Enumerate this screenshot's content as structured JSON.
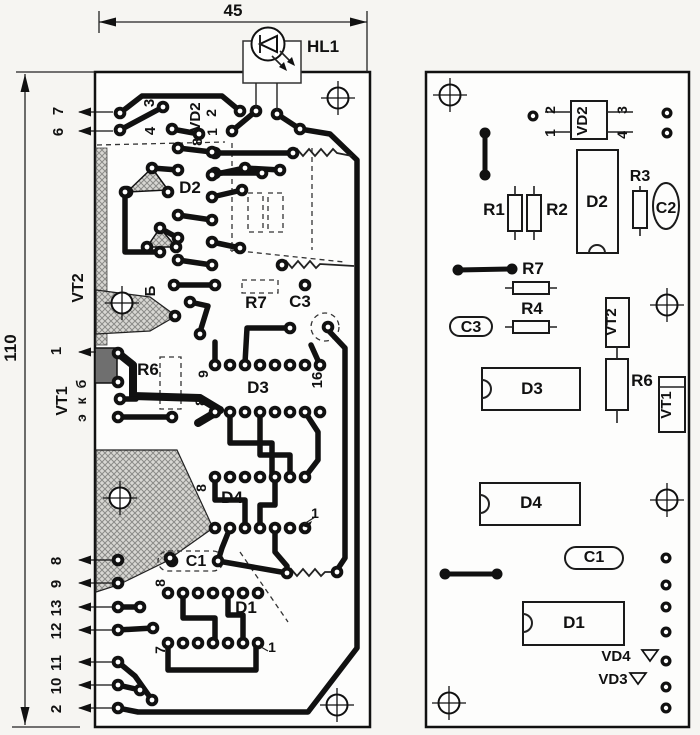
{
  "drawing": "printed-circuit-board-layout",
  "colors": {
    "ink": "#111111",
    "paper": "#f6f5f2",
    "board": "#fdfdfc",
    "copper_hatch": "#d8d7d3"
  },
  "board_dimensions": {
    "width_label": "45",
    "height_label": "110"
  },
  "labels": [
    {
      "t": "45",
      "x": 233,
      "y": 16,
      "r": 0,
      "s": 17,
      "g": "labels-anno"
    },
    {
      "t": "110",
      "x": 16,
      "y": 348,
      "r": -90,
      "s": 17,
      "g": "labels-anno"
    },
    {
      "t": "HL1",
      "x": 323,
      "y": 52,
      "r": 0,
      "s": 17,
      "g": "labels-anno"
    },
    {
      "t": "7",
      "x": 63,
      "y": 111,
      "r": -90,
      "s": 15,
      "g": "labels-left"
    },
    {
      "t": "6",
      "x": 63,
      "y": 132,
      "r": -90,
      "s": 15,
      "g": "labels-left"
    },
    {
      "t": "3",
      "x": 154,
      "y": 103,
      "r": -90,
      "s": 15,
      "g": "labels-left"
    },
    {
      "t": "4",
      "x": 155,
      "y": 131,
      "r": -90,
      "s": 15,
      "g": "labels-left"
    },
    {
      "t": "VD2",
      "x": 200,
      "y": 117,
      "r": -90,
      "s": 15,
      "g": "labels-left"
    },
    {
      "t": "2",
      "x": 216,
      "y": 113,
      "r": -90,
      "s": 14,
      "g": "labels-left"
    },
    {
      "t": "1",
      "x": 217,
      "y": 132,
      "r": -90,
      "s": 14,
      "g": "labels-left"
    },
    {
      "t": "8",
      "x": 202,
      "y": 142,
      "r": -90,
      "s": 14,
      "g": "labels-left"
    },
    {
      "t": "D2",
      "x": 190,
      "y": 193,
      "r": 0,
      "s": 17,
      "g": "labels-left"
    },
    {
      "t": "VT2",
      "x": 83,
      "y": 288,
      "r": -90,
      "s": 16,
      "g": "labels-left"
    },
    {
      "t": "Б",
      "x": 155,
      "y": 291,
      "r": -90,
      "s": 15,
      "g": "labels-left"
    },
    {
      "t": "R7",
      "x": 256,
      "y": 308,
      "r": 0,
      "s": 17,
      "g": "labels-left"
    },
    {
      "t": "C3",
      "x": 300,
      "y": 307,
      "r": 0,
      "s": 17,
      "g": "labels-left"
    },
    {
      "t": "1",
      "x": 61,
      "y": 351,
      "r": -90,
      "s": 15,
      "g": "labels-left"
    },
    {
      "t": "R6",
      "x": 148,
      "y": 375,
      "r": 0,
      "s": 17,
      "g": "labels-left"
    },
    {
      "t": "VT1",
      "x": 67,
      "y": 401,
      "r": -90,
      "s": 16,
      "g": "labels-left"
    },
    {
      "t": "б",
      "x": 86,
      "y": 384,
      "r": -90,
      "s": 14,
      "g": "labels-left"
    },
    {
      "t": "к",
      "x": 86,
      "y": 401,
      "r": -90,
      "s": 14,
      "g": "labels-left"
    },
    {
      "t": "э",
      "x": 86,
      "y": 418,
      "r": -90,
      "s": 14,
      "g": "labels-left"
    },
    {
      "t": "9",
      "x": 208,
      "y": 374,
      "r": -90,
      "s": 14,
      "g": "labels-left"
    },
    {
      "t": "16",
      "x": 322,
      "y": 380,
      "r": -90,
      "s": 15,
      "g": "labels-left"
    },
    {
      "t": "D3",
      "x": 258,
      "y": 393,
      "r": 0,
      "s": 17,
      "g": "labels-left"
    },
    {
      "t": "8",
      "x": 205,
      "y": 402,
      "r": -90,
      "s": 14,
      "g": "labels-left"
    },
    {
      "t": "8",
      "x": 206,
      "y": 488,
      "r": -90,
      "s": 14,
      "g": "labels-left"
    },
    {
      "t": "D4",
      "x": 232,
      "y": 503,
      "r": 0,
      "s": 17,
      "g": "labels-left"
    },
    {
      "t": "1",
      "x": 315,
      "y": 518,
      "r": 0,
      "s": 14,
      "g": "labels-left"
    },
    {
      "t": "C1",
      "x": 196,
      "y": 566,
      "r": 0,
      "s": 16,
      "g": "labels-left"
    },
    {
      "t": "8",
      "x": 165,
      "y": 583,
      "r": -90,
      "s": 14,
      "g": "labels-left"
    },
    {
      "t": "D1",
      "x": 246,
      "y": 613,
      "r": 0,
      "s": 17,
      "g": "labels-left"
    },
    {
      "t": "7",
      "x": 165,
      "y": 650,
      "r": -90,
      "s": 14,
      "g": "labels-left"
    },
    {
      "t": "1",
      "x": 272,
      "y": 652,
      "r": 0,
      "s": 14,
      "g": "labels-left"
    },
    {
      "t": "8",
      "x": 61,
      "y": 561,
      "r": -90,
      "s": 15,
      "g": "labels-left"
    },
    {
      "t": "9",
      "x": 61,
      "y": 584,
      "r": -90,
      "s": 15,
      "g": "labels-left"
    },
    {
      "t": "13",
      "x": 61,
      "y": 608,
      "r": -90,
      "s": 15,
      "g": "labels-left"
    },
    {
      "t": "12",
      "x": 61,
      "y": 631,
      "r": -90,
      "s": 15,
      "g": "labels-left"
    },
    {
      "t": "11",
      "x": 61,
      "y": 663,
      "r": -90,
      "s": 15,
      "g": "labels-left"
    },
    {
      "t": "10",
      "x": 61,
      "y": 686,
      "r": -90,
      "s": 15,
      "g": "labels-left"
    },
    {
      "t": "2",
      "x": 61,
      "y": 709,
      "r": -90,
      "s": 15,
      "g": "labels-left"
    },
    {
      "t": "2",
      "x": 555,
      "y": 110,
      "r": -90,
      "s": 14,
      "g": "labels-right"
    },
    {
      "t": "1",
      "x": 555,
      "y": 133,
      "r": -90,
      "s": 14,
      "g": "labels-right"
    },
    {
      "t": "VD2",
      "x": 587,
      "y": 121,
      "r": -90,
      "s": 15,
      "g": "labels-right"
    },
    {
      "t": "3",
      "x": 627,
      "y": 110,
      "r": -90,
      "s": 14,
      "g": "labels-right"
    },
    {
      "t": "4",
      "x": 627,
      "y": 135,
      "r": -90,
      "s": 14,
      "g": "labels-right"
    },
    {
      "t": "R1",
      "x": 494,
      "y": 215,
      "r": 0,
      "s": 17,
      "g": "labels-right"
    },
    {
      "t": "R2",
      "x": 557,
      "y": 215,
      "r": 0,
      "s": 17,
      "g": "labels-right"
    },
    {
      "t": "D2",
      "x": 597,
      "y": 207,
      "r": 0,
      "s": 17,
      "g": "labels-right"
    },
    {
      "t": "R3",
      "x": 640,
      "y": 181,
      "r": 0,
      "s": 16,
      "g": "labels-right"
    },
    {
      "t": "C2",
      "x": 666,
      "y": 213,
      "r": 0,
      "s": 16,
      "g": "labels-right"
    },
    {
      "t": "R7",
      "x": 533,
      "y": 274,
      "r": 0,
      "s": 17,
      "g": "labels-right"
    },
    {
      "t": "C3",
      "x": 471,
      "y": 332,
      "r": 0,
      "s": 16,
      "g": "labels-right"
    },
    {
      "t": "R4",
      "x": 532,
      "y": 314,
      "r": 0,
      "s": 17,
      "g": "labels-right"
    },
    {
      "t": "VT2",
      "x": 616,
      "y": 322,
      "r": -90,
      "s": 15,
      "g": "labels-right"
    },
    {
      "t": "D3",
      "x": 532,
      "y": 394,
      "r": 0,
      "s": 17,
      "g": "labels-right"
    },
    {
      "t": "R6",
      "x": 642,
      "y": 386,
      "r": 0,
      "s": 17,
      "g": "labels-right"
    },
    {
      "t": "VT1",
      "x": 671,
      "y": 405,
      "r": -90,
      "s": 15,
      "g": "labels-right"
    },
    {
      "t": "D4",
      "x": 531,
      "y": 508,
      "r": 0,
      "s": 17,
      "g": "labels-right"
    },
    {
      "t": "C1",
      "x": 594,
      "y": 562,
      "r": 0,
      "s": 16,
      "g": "labels-right"
    },
    {
      "t": "D1",
      "x": 574,
      "y": 628,
      "r": 0,
      "s": 17,
      "g": "labels-right"
    },
    {
      "t": "VD4",
      "x": 616,
      "y": 661,
      "r": 0,
      "s": 15,
      "g": "labels-right"
    },
    {
      "t": "VD3",
      "x": 613,
      "y": 684,
      "r": 0,
      "s": 15,
      "g": "labels-right"
    }
  ]
}
